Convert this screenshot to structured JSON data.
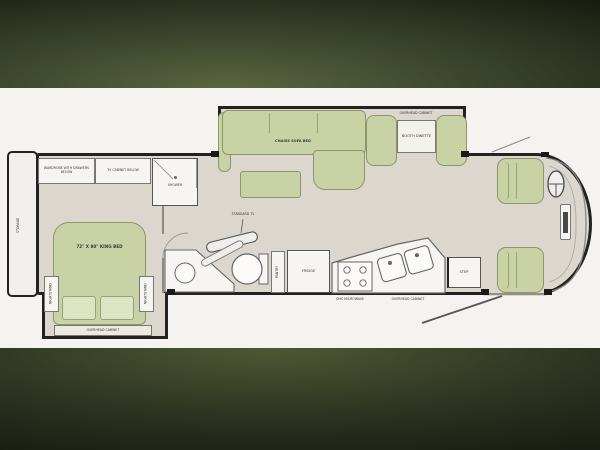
{
  "floorplan": {
    "rear": {
      "storage": "STORAGE"
    },
    "bedroom": {
      "wardrobe": "WARDROBE WITH DRAWERS BELOW",
      "tv_cabinet": "TV CABINET BELOW",
      "king_bed": "72\" X 80\" KING BED",
      "nightstand": "NIGHTSTAND",
      "overhead_cabinet": "OVERHEAD CABINET"
    },
    "bath": {
      "shower": "SHOWER",
      "lav": "LAV"
    },
    "living": {
      "standard_tv": "STANDARD TV",
      "chaise_sofa_bed": "CHAISE SOFA BED"
    },
    "dinette": {
      "overhead_cabinet": "OVERHEAD CABINET",
      "booth_dinette": "BOOTH DINETTE"
    },
    "kitchen": {
      "pantry": "PANTRY",
      "fridge": "FRIDGE",
      "ohc_microwave": "OHC  MICROWAVE",
      "overhead_cabinet": "OVERHEAD CABINET"
    },
    "entry": {
      "step": "STEP"
    }
  },
  "colors": {
    "upholstery": "#c8d2a4",
    "upholstery_border": "#8d9768",
    "floor": "#dbd7cf",
    "wall": "#1d1d1b",
    "letterbox": "#171b0f",
    "photo_background": "#f4f3f0"
  }
}
